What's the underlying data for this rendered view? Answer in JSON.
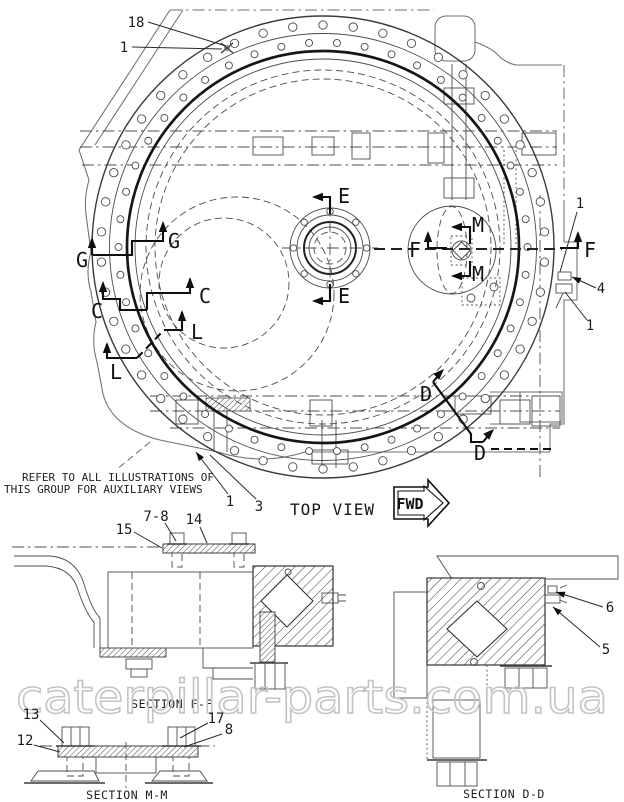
{
  "notes": {
    "line1": "REFER TO ALL ILLUSTRATIONS OF",
    "line2": "THIS GROUP FOR AUXILIARY VIEWS"
  },
  "top_view": {
    "label": "TOP VIEW",
    "fwd_label": "FWD",
    "section_markers": [
      {
        "letter": "E",
        "lx": 338,
        "ly": 203,
        "anchor": "start",
        "paths": [
          {
            "d": "M 330,214 L 330,197 L 314,197"
          }
        ],
        "arrows": [
          [
            312,
            197,
            180
          ]
        ]
      },
      {
        "letter": "E",
        "lx": 338,
        "ly": 303,
        "anchor": "start",
        "paths": [
          {
            "d": "M 330,284 L 330,301 L 314,301"
          }
        ],
        "arrows": [
          [
            312,
            301,
            180
          ]
        ]
      },
      {
        "letter": "F",
        "lx": 421,
        "ly": 257,
        "anchor": "end",
        "paths": [
          {
            "d": "M 447,248 L 428,248 L 428,233"
          }
        ],
        "arrows": [
          [
            428,
            231,
            270
          ]
        ]
      },
      {
        "letter": "F",
        "lx": 584,
        "ly": 257,
        "anchor": "start",
        "paths": [
          {
            "d": "M 560,248 L 578,248 L 578,233"
          }
        ],
        "arrows": [
          [
            578,
            231,
            270
          ]
        ]
      },
      {
        "letter": "G",
        "lx": 82,
        "ly": 267,
        "anchor": "middle",
        "paths": [
          {
            "d": "M 92,255 L 92,239"
          }
        ],
        "arrows": [
          [
            92,
            237,
            270
          ]
        ]
      },
      {
        "letter": "G",
        "lx": 168,
        "ly": 248,
        "anchor": "start",
        "paths": [
          {
            "d": "M 92,255 L 132,255 L 132,241 L 163,241 L 163,223"
          }
        ],
        "arrows": [
          [
            163,
            221,
            270
          ]
        ]
      },
      {
        "letter": "C",
        "lx": 97,
        "ly": 318,
        "anchor": "middle",
        "paths": [
          {
            "d": "M 103,283 L 103,299 L 120,299 L 120,310 L 147,310"
          }
        ],
        "arrows": [
          [
            103,
            281,
            270
          ]
        ]
      },
      {
        "letter": "C",
        "lx": 199,
        "ly": 303,
        "anchor": "start",
        "paths": [
          {
            "d": "M 147,310 L 147,293 L 190,293 L 190,279"
          }
        ],
        "arrows": [
          [
            190,
            277,
            270
          ]
        ]
      },
      {
        "letter": "L",
        "lx": 116,
        "ly": 379,
        "anchor": "middle",
        "paths": [
          {
            "d": "M 107,344 L 107,358 L 137,358"
          },
          {
            "d": "M 137,358 L 164,330",
            "dash": true
          }
        ],
        "arrows": [
          [
            107,
            342,
            270
          ]
        ]
      },
      {
        "letter": "L",
        "lx": 191,
        "ly": 339,
        "anchor": "start",
        "paths": [
          {
            "d": "M 164,330 L 182,330 L 182,312"
          }
        ],
        "arrows": [
          [
            182,
            310,
            270
          ]
        ]
      },
      {
        "letter": "M",
        "lx": 472,
        "ly": 232,
        "anchor": "start",
        "paths": [
          {
            "d": "M 470,244 L 470,227 L 453,227"
          }
        ],
        "arrows": [
          [
            451,
            227,
            180
          ]
        ]
      },
      {
        "letter": "M",
        "lx": 472,
        "ly": 281,
        "anchor": "start",
        "paths": [
          {
            "d": "M 470,261 L 470,276 L 453,276"
          }
        ],
        "arrows": [
          [
            451,
            276,
            180
          ]
        ]
      },
      {
        "letter": "D",
        "lx": 426,
        "ly": 401,
        "anchor": "middle",
        "paths": [
          {
            "d": "M 433,382 L 471,434 L 471,442 L 483,442"
          },
          {
            "d": "M 433,382 L 442,371"
          }
        ],
        "arrows": [
          [
            444,
            369,
            315
          ]
        ]
      },
      {
        "letter": "D",
        "lx": 480,
        "ly": 460,
        "anchor": "middle",
        "paths": [
          {
            "d": "M 483,442 L 492,431"
          },
          {
            "d": "M 491,449 L 556,449",
            "dash": true
          }
        ],
        "arrows": [
          [
            494,
            429,
            315
          ]
        ]
      }
    ],
    "callouts": [
      {
        "label": "18",
        "x": 136,
        "y": 27,
        "leader": [
          148,
          22,
          226,
          46
        ],
        "arrow": false
      },
      {
        "label": "1",
        "x": 124,
        "y": 52,
        "leader": [
          132,
          47,
          222,
          49
        ],
        "arrow": false
      },
      {
        "label": "1",
        "x": 580,
        "y": 208,
        "leader": [
          577,
          212,
          560,
          272
        ],
        "arrow": false
      },
      {
        "label": "4",
        "x": 601,
        "y": 293,
        "leader": [
          596,
          288,
          572,
          277
        ],
        "arrow": true
      },
      {
        "label": "1",
        "x": 590,
        "y": 330,
        "leader": [
          587,
          320,
          565,
          292
        ],
        "arrow": false
      },
      {
        "label": "1",
        "x": 230,
        "y": 506,
        "leader": [
          228,
          494,
          196,
          452
        ],
        "arrow": true
      },
      {
        "label": "3",
        "x": 259,
        "y": 511,
        "leader": [
          256,
          499,
          210,
          455
        ],
        "arrow": false
      }
    ]
  },
  "sections": {
    "ff": {
      "label": "SECTION F-F",
      "callouts": [
        {
          "label": "15",
          "x": 124,
          "y": 534,
          "leader": [
            134,
            532,
            162,
            548
          ],
          "arrow": false
        },
        {
          "label": "7-8",
          "x": 156,
          "y": 521,
          "leader": [
            165,
            523,
            176,
            541
          ],
          "arrow": false
        },
        {
          "label": "14",
          "x": 194,
          "y": 524,
          "leader": [
            200,
            527,
            207,
            543
          ],
          "arrow": false
        }
      ]
    },
    "mm": {
      "label": "SECTION M-M",
      "callouts": [
        {
          "label": "13",
          "x": 31,
          "y": 719,
          "leader": [
            40,
            720,
            64,
            743
          ],
          "arrow": false
        },
        {
          "label": "12",
          "x": 25,
          "y": 745,
          "leader": [
            34,
            745,
            60,
            752
          ],
          "arrow": false
        },
        {
          "label": "17",
          "x": 216,
          "y": 723,
          "leader": [
            208,
            723,
            180,
            738
          ],
          "arrow": false
        },
        {
          "label": "8",
          "x": 229,
          "y": 734,
          "leader": [
            222,
            734,
            184,
            747
          ],
          "arrow": false
        }
      ]
    },
    "dd": {
      "label": "SECTION D-D",
      "callouts": [
        {
          "label": "6",
          "x": 610,
          "y": 612,
          "leader": [
            603,
            607,
            556,
            592
          ],
          "arrow": true
        },
        {
          "label": "5",
          "x": 606,
          "y": 654,
          "leader": [
            600,
            647,
            553,
            607
          ],
          "arrow": true
        }
      ]
    }
  },
  "watermark": {
    "text": "caterpillar-parts.com.ua",
    "color": "#c3c3c3"
  },
  "colors": {
    "line": "#2a2a2a",
    "outline": "#6f6f6f",
    "background": "#ffffff"
  }
}
